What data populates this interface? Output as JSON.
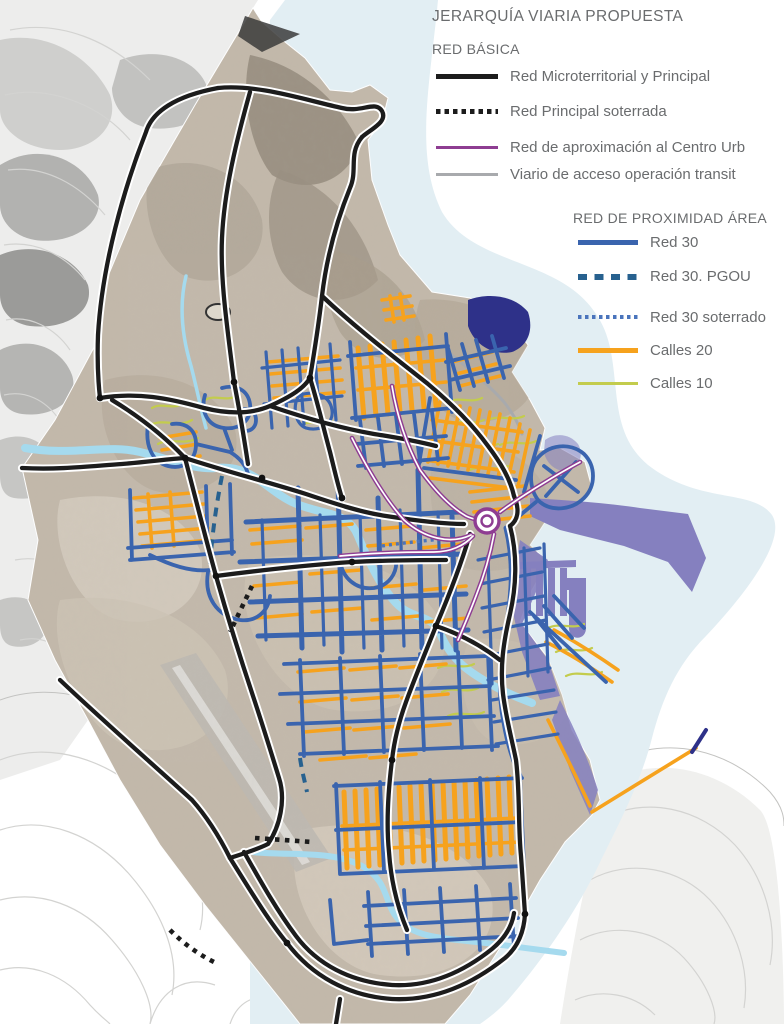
{
  "legend": {
    "title": "JERARQUÍA VIARIA PROPUESTA",
    "sections": [
      {
        "header": "RED BÁSICA",
        "items": [
          {
            "label": "Red Microterritorial y Principal",
            "line": "solid",
            "color": "#1c1c1c"
          },
          {
            "label": "Red Principal soterrada",
            "line": "dotted",
            "color": "#1c1c1c"
          },
          {
            "label": "Red de aproximación al Centro Urb",
            "line": "solid",
            "color": "#8e3d92"
          },
          {
            "label": "Viario de acceso operación transit",
            "line": "solid",
            "color": "#a8aaad"
          }
        ]
      },
      {
        "header": "RED DE PROXIMIDAD ÁREA",
        "items": [
          {
            "label": "Red 30",
            "line": "solid",
            "color": "#3a64ae"
          },
          {
            "label": "Red 30. PGOU",
            "line": "dashed",
            "color": "#27618f"
          },
          {
            "label": "Red 30 soterrado",
            "line": "dotted",
            "color": "#4a74bc"
          },
          {
            "label": "Calles 20",
            "line": "solid",
            "color": "#f6a21d"
          },
          {
            "label": "Calles 10",
            "line": "solid",
            "color": "#c3cc4d"
          }
        ]
      }
    ]
  },
  "colors": {
    "road_primary": "#1c1c1c",
    "road_approach": "#8e3d92",
    "road_access": "#a8aaad",
    "red30": "#3a64ae",
    "red30_pgou": "#27618f",
    "red30_soterrado": "#4a74bc",
    "calles20": "#f6a21d",
    "calles10": "#c3cc4d",
    "sea": "#e2eef3",
    "river": "#a5daee",
    "port": "#8580bf",
    "port_dark": "#2e3189",
    "legend_text": "#6a6c6e"
  }
}
